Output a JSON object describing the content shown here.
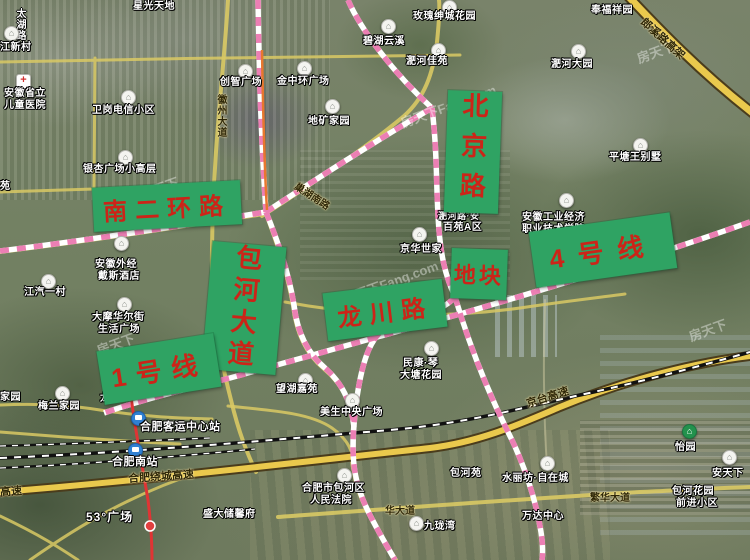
{
  "watermark": {
    "full": "房天下Fang.com",
    "short": "房天下"
  },
  "colors": {
    "green_label_bg": "#2fa363",
    "green_label_text": "#cc2418",
    "metro_pink": "#ec7fb4",
    "metro_red": "#e03434",
    "metro_orange": "#e8772e",
    "highway_yellow": "#eac94d",
    "road_yellow": "#d9c964",
    "railway_black": "#111111"
  },
  "icons": {
    "house_pin": "⌂",
    "hospital_cross": "+"
  },
  "green_labels": {
    "nan_er_huan": "南二环路",
    "beijing_lu": "北京路",
    "baohe_dadao": "包河大道",
    "longchuan_lu": "龙川路",
    "dikuai": "地块",
    "line4": "4号线",
    "line1": "1号线"
  },
  "road_labels": {
    "taihu_lu": "太湖路",
    "huizhou_dadao": "徽州大道",
    "langxi_gaojia": "郎溪路高架",
    "chaohu_nanlu": "巢湖南路",
    "raocheng_gaosu": "合肥绕城高速",
    "gaosu_partial": "高速",
    "jingtai_gaosu": "京台高速",
    "fanhua_dadao": "繁华大道",
    "fanhua_partial": "华大道",
    "long_char": "龙"
  },
  "pois": {
    "xingguang": "星光天地",
    "jiangxincun": "江新村",
    "ertong_l1": "安徽省立",
    "ertong_l2": "儿童医院",
    "weigang": "卫岗电信小区",
    "chuangzhi": "创智广场",
    "jinzhonghuan": "金中环广场",
    "meigui": "玫瑰绅城花园",
    "bihu": "碧湖云溪",
    "feihe_jiayuan": "淝河佳苑",
    "fengfu": "奉福祥园",
    "feihe_dayuan": "淝河大园",
    "dikuang": "地矿家园",
    "pingtang": "平塘王别墅",
    "yinxing": "银杏广场小高层",
    "yuan_partial": "苑",
    "waijing_l1": "安徽外经",
    "waijing_l2": "戴斯酒店",
    "jiangqi": "江汽一村",
    "jinghua": "京华世家",
    "baiyuan_l1": "淝河路·安",
    "baiyuan_l2": "百苑A区",
    "gongye_l1": "安徽工业经济",
    "gongye_l2": "职业技术学院",
    "damo_l1": "大摩华尔街",
    "damo_l2": "生活广场",
    "wanghu": "望湖嘉苑",
    "meisheng": "美生中央广场",
    "minkang_l1": "民康·琴",
    "minkang_l2": "大塘花园",
    "meilan": "梅兰家园",
    "jiayuan_partial": "家园",
    "keyun": "合肥客运中心站",
    "nanzhan": "合肥南站",
    "guangchang53": "53°广场",
    "shengda": "盛大储馨府",
    "fayuan_l1": "合肥市包河区",
    "fayuan_l2": "人民法院",
    "baoheyuan": "包河苑",
    "jiulongwan": "九珑湾",
    "wanda": "万达中心",
    "yiyuan": "怡园",
    "shuilifang": "水丽坊·自在城",
    "antianxia": "安天下",
    "baohehy_l1": "包河花园",
    "baohehy_l2": "前进小区"
  }
}
